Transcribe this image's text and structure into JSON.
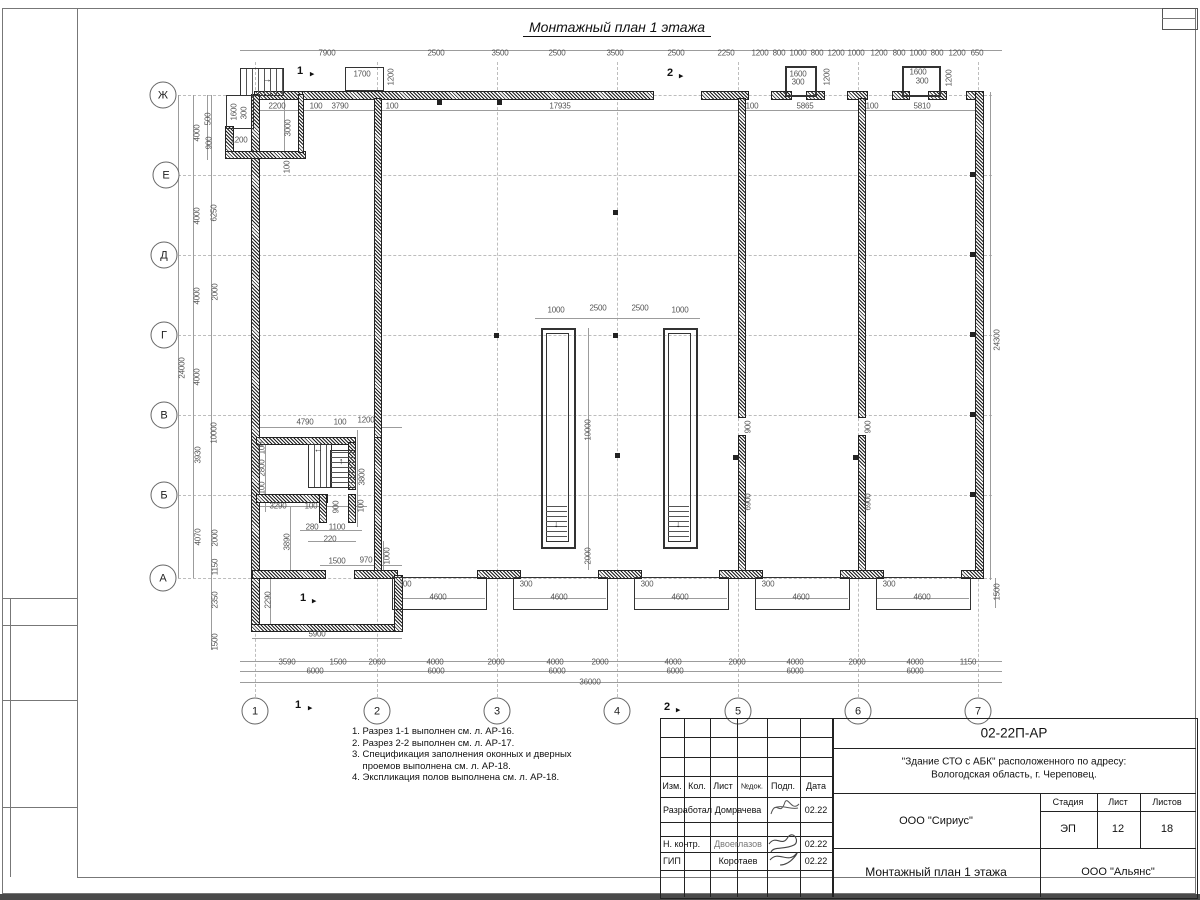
{
  "sheet": {
    "title": "Монтажный план 1 этажа"
  },
  "notes": {
    "lines": [
      "1. Разрез 1-1 выполнен см. л. АР-16.",
      "2. Разрез 2-2 выполнен см. л. АР-17.",
      "3. Спецификация заполнения оконных и дверных",
      "    проемов выполнена см. л. АР-18.",
      "4. Экспликация полов выполнена см. л. АР-18."
    ]
  },
  "stamp": {
    "doc_code": "02-22П-АР",
    "object_line1": "\"Здание СТО с АБК\" расположенного по адресу:",
    "object_line2": "Вологодская область, г. Череповец.",
    "org": "ООО \"Сириус\"",
    "drawing_name": "Монтажный план 1 этажа",
    "org2": "ООО \"Альянс\"",
    "header": {
      "izm": "Изм.",
      "kol": "Кол.",
      "list": "Лист",
      "ndoc": "№док.",
      "podp": "Подп.",
      "data": "Дата"
    },
    "stage_label": "Стадия",
    "sheet_label": "Лист",
    "sheets_label": "Листов",
    "stage": "ЭП",
    "sheet_no": "12",
    "sheets_total": "18",
    "rows": [
      {
        "role": "Разработал",
        "name": "Домрачева",
        "date": "02.22"
      },
      {
        "role": "Н. контр.",
        "name": "Двоеглазов",
        "date": "02.22"
      },
      {
        "role": "ГИП",
        "name": "Коротаев",
        "date": "02.22"
      }
    ]
  },
  "plan": {
    "axes_v": [
      255,
      377,
      497,
      617,
      738,
      858,
      978
    ],
    "axes_h": [
      95,
      175,
      255,
      335,
      415,
      495,
      578
    ],
    "bubbles": [
      {
        "t": "Ж",
        "x": 163,
        "y": 95
      },
      {
        "t": "Е",
        "x": 166,
        "y": 175
      },
      {
        "t": "Д",
        "x": 164,
        "y": 255
      },
      {
        "t": "Г",
        "x": 164,
        "y": 335
      },
      {
        "t": "В",
        "x": 164,
        "y": 415
      },
      {
        "t": "Б",
        "x": 164,
        "y": 495
      },
      {
        "t": "А",
        "x": 163,
        "y": 578
      },
      {
        "t": "1",
        "x": 255,
        "y": 711
      },
      {
        "t": "2",
        "x": 377,
        "y": 711
      },
      {
        "t": "3",
        "x": 497,
        "y": 711
      },
      {
        "t": "4",
        "x": 617,
        "y": 711
      },
      {
        "t": "5",
        "x": 738,
        "y": 711
      },
      {
        "t": "6",
        "x": 858,
        "y": 711
      },
      {
        "t": "7",
        "x": 978,
        "y": 711
      }
    ],
    "walls": [
      [
        255,
        92,
        48,
        7
      ],
      [
        303,
        92,
        350,
        7
      ],
      [
        702,
        92,
        46,
        7
      ],
      [
        772,
        92,
        19,
        7
      ],
      [
        807,
        92,
        17,
        7
      ],
      [
        848,
        92,
        19,
        7
      ],
      [
        893,
        92,
        16,
        7
      ],
      [
        929,
        92,
        17,
        7
      ],
      [
        967,
        92,
        16,
        7
      ],
      [
        976,
        92,
        7,
        486
      ],
      [
        252,
        95,
        7,
        536
      ],
      [
        226,
        127,
        7,
        26
      ],
      [
        226,
        152,
        79,
        6
      ],
      [
        299,
        95,
        4,
        57
      ],
      [
        375,
        99,
        6,
        339
      ],
      [
        375,
        438,
        6,
        133
      ],
      [
        739,
        99,
        6,
        318
      ],
      [
        739,
        436,
        6,
        135
      ],
      [
        859,
        99,
        6,
        318
      ],
      [
        859,
        436,
        6,
        135
      ],
      [
        257,
        438,
        98,
        6
      ],
      [
        349,
        443,
        6,
        46
      ],
      [
        257,
        495,
        70,
        7
      ],
      [
        320,
        495,
        6,
        27
      ],
      [
        349,
        495,
        6,
        27
      ],
      [
        478,
        571,
        42,
        7
      ],
      [
        599,
        571,
        42,
        7
      ],
      [
        720,
        571,
        42,
        7
      ],
      [
        841,
        571,
        42,
        7
      ],
      [
        962,
        571,
        21,
        7
      ],
      [
        253,
        571,
        72,
        7
      ],
      [
        355,
        571,
        42,
        7
      ],
      [
        252,
        625,
        150,
        6
      ],
      [
        395,
        576,
        7,
        55
      ]
    ],
    "outlines": [
      {
        "x": 226,
        "y": 95,
        "w": 26,
        "h": 32,
        "b": 1
      },
      {
        "x": 345,
        "y": 67,
        "w": 37,
        "h": 22,
        "b": 1
      },
      {
        "x": 785,
        "y": 66,
        "w": 28,
        "h": 27,
        "b": 2
      },
      {
        "x": 902,
        "y": 66,
        "w": 35,
        "h": 27,
        "b": 2
      },
      {
        "x": 541,
        "y": 328,
        "w": 31,
        "h": 217,
        "b": 2
      },
      {
        "x": 546,
        "y": 333,
        "w": 21,
        "h": 207,
        "b": 1
      },
      {
        "x": 663,
        "y": 328,
        "w": 31,
        "h": 217,
        "b": 2
      },
      {
        "x": 668,
        "y": 333,
        "w": 21,
        "h": 207,
        "b": 1
      },
      {
        "x": 392,
        "y": 577,
        "w": 93,
        "h": 31,
        "b": 1
      },
      {
        "x": 513,
        "y": 577,
        "w": 93,
        "h": 31,
        "b": 1
      },
      {
        "x": 634,
        "y": 577,
        "w": 93,
        "h": 31,
        "b": 1
      },
      {
        "x": 755,
        "y": 577,
        "w": 93,
        "h": 31,
        "b": 1
      },
      {
        "x": 876,
        "y": 577,
        "w": 93,
        "h": 31,
        "b": 1
      },
      {
        "x": 240,
        "y": 68,
        "w": 42,
        "h": 26,
        "b": 1,
        "s": "stripes-v"
      },
      {
        "x": 308,
        "y": 444,
        "w": 22,
        "h": 42,
        "b": 1,
        "s": "stripes-v"
      },
      {
        "x": 330,
        "y": 450,
        "w": 24,
        "h": 36,
        "b": 1,
        "s": "stripes-h"
      },
      {
        "x": 546,
        "y": 505,
        "w": 21,
        "h": 36,
        "b": 0,
        "s": "stripes-h"
      },
      {
        "x": 668,
        "y": 505,
        "w": 21,
        "h": 36,
        "b": 0,
        "s": "stripes-h"
      }
    ],
    "squares": [
      [
        437,
        100
      ],
      [
        497,
        100
      ],
      [
        613,
        210
      ],
      [
        613,
        333
      ],
      [
        615,
        453
      ],
      [
        494,
        333
      ],
      [
        970,
        172
      ],
      [
        970,
        252
      ],
      [
        970,
        332
      ],
      [
        970,
        412
      ],
      [
        970,
        492
      ],
      [
        733,
        455
      ],
      [
        853,
        455
      ]
    ],
    "dimlines": [
      [
        240,
        50,
        762,
        1
      ],
      [
        255,
        110,
        727,
        1
      ],
      [
        535,
        318,
        165,
        1
      ],
      [
        255,
        427,
        147,
        1
      ],
      [
        255,
        506,
        112,
        1
      ],
      [
        300,
        530,
        62,
        1
      ],
      [
        308,
        541,
        48,
        1
      ],
      [
        320,
        565,
        82,
        1
      ],
      [
        392,
        598,
        93,
        1
      ],
      [
        513,
        598,
        93,
        1
      ],
      [
        634,
        598,
        93,
        1
      ],
      [
        755,
        598,
        93,
        1
      ],
      [
        876,
        598,
        93,
        1
      ],
      [
        252,
        638,
        150,
        1
      ],
      [
        240,
        661,
        762,
        1
      ],
      [
        240,
        671,
        762,
        1
      ],
      [
        240,
        682,
        762,
        1
      ],
      [
        178,
        95,
        1,
        483
      ],
      [
        193,
        95,
        1,
        483
      ],
      [
        211,
        95,
        1,
        555
      ],
      [
        990,
        92,
        1,
        488
      ],
      [
        995,
        578,
        1,
        30
      ],
      [
        588,
        328,
        1,
        242
      ],
      [
        265,
        438,
        1,
        74
      ],
      [
        290,
        506,
        1,
        72
      ],
      [
        357,
        430,
        1,
        97
      ],
      [
        383,
        541,
        1,
        31
      ],
      [
        270,
        578,
        1,
        50
      ],
      [
        284,
        99,
        1,
        53
      ],
      [
        207,
        95,
        1,
        65
      ]
    ],
    "labels": [
      {
        "t": "7900",
        "x": 327,
        "y": 53
      },
      {
        "t": "2500",
        "x": 436,
        "y": 53
      },
      {
        "t": "3500",
        "x": 500,
        "y": 53
      },
      {
        "t": "2500",
        "x": 557,
        "y": 53
      },
      {
        "t": "3500",
        "x": 615,
        "y": 53
      },
      {
        "t": "2500",
        "x": 676,
        "y": 53
      },
      {
        "t": "2250",
        "x": 726,
        "y": 53
      },
      {
        "t": "1200",
        "x": 760,
        "y": 53
      },
      {
        "t": "800",
        "x": 779,
        "y": 53
      },
      {
        "t": "1000",
        "x": 798,
        "y": 53
      },
      {
        "t": "800",
        "x": 817,
        "y": 53
      },
      {
        "t": "1200",
        "x": 836,
        "y": 53
      },
      {
        "t": "1000",
        "x": 856,
        "y": 53
      },
      {
        "t": "1200",
        "x": 879,
        "y": 53
      },
      {
        "t": "800",
        "x": 899,
        "y": 53
      },
      {
        "t": "1000",
        "x": 918,
        "y": 53
      },
      {
        "t": "800",
        "x": 937,
        "y": 53
      },
      {
        "t": "1200",
        "x": 957,
        "y": 53
      },
      {
        "t": "650",
        "x": 977,
        "y": 53
      },
      {
        "t": "1700",
        "x": 362,
        "y": 74
      },
      {
        "t": "1200",
        "x": 391,
        "y": 77,
        "r": 1
      },
      {
        "t": "1600",
        "x": 798,
        "y": 74
      },
      {
        "t": "300",
        "x": 798,
        "y": 82
      },
      {
        "t": "1200",
        "x": 827,
        "y": 77,
        "r": 1
      },
      {
        "t": "1600",
        "x": 918,
        "y": 72
      },
      {
        "t": "300",
        "x": 922,
        "y": 81
      },
      {
        "t": "1200",
        "x": 949,
        "y": 78,
        "r": 1
      },
      {
        "t": "2200",
        "x": 277,
        "y": 106
      },
      {
        "t": "100",
        "x": 316,
        "y": 106
      },
      {
        "t": "3790",
        "x": 340,
        "y": 106
      },
      {
        "t": "100",
        "x": 392,
        "y": 106
      },
      {
        "t": "17935",
        "x": 560,
        "y": 106
      },
      {
        "t": "100",
        "x": 752,
        "y": 106
      },
      {
        "t": "5865",
        "x": 805,
        "y": 106
      },
      {
        "t": "100",
        "x": 872,
        "y": 106
      },
      {
        "t": "5810",
        "x": 922,
        "y": 106
      },
      {
        "t": "1600",
        "x": 234,
        "y": 112,
        "r": 1
      },
      {
        "t": "300",
        "x": 244,
        "y": 113,
        "r": 1
      },
      {
        "t": "1200",
        "x": 239,
        "y": 140
      },
      {
        "t": "3000",
        "x": 288,
        "y": 128,
        "r": 1
      },
      {
        "t": "100",
        "x": 287,
        "y": 167,
        "r": 1
      },
      {
        "t": "24000",
        "x": 182,
        "y": 368,
        "r": 1
      },
      {
        "t": "4000",
        "x": 197,
        "y": 133,
        "r": 1
      },
      {
        "t": "4000",
        "x": 197,
        "y": 216,
        "r": 1
      },
      {
        "t": "4000",
        "x": 197,
        "y": 296,
        "r": 1
      },
      {
        "t": "4000",
        "x": 197,
        "y": 377,
        "r": 1
      },
      {
        "t": "3930",
        "x": 198,
        "y": 455,
        "r": 1
      },
      {
        "t": "4070",
        "x": 198,
        "y": 537,
        "r": 1
      },
      {
        "t": "500",
        "x": 208,
        "y": 119,
        "r": 1
      },
      {
        "t": "900",
        "x": 209,
        "y": 143,
        "r": 1
      },
      {
        "t": "6250",
        "x": 214,
        "y": 213,
        "r": 1
      },
      {
        "t": "2000",
        "x": 215,
        "y": 292,
        "r": 1
      },
      {
        "t": "10000",
        "x": 214,
        "y": 433,
        "r": 1
      },
      {
        "t": "2000",
        "x": 215,
        "y": 538,
        "r": 1
      },
      {
        "t": "1150",
        "x": 215,
        "y": 567,
        "r": 1
      },
      {
        "t": "2350",
        "x": 215,
        "y": 600,
        "r": 1
      },
      {
        "t": "1500",
        "x": 215,
        "y": 642,
        "r": 1
      },
      {
        "t": "24300",
        "x": 997,
        "y": 340,
        "r": 1
      },
      {
        "t": "1500",
        "x": 997,
        "y": 592,
        "r": 1
      },
      {
        "t": "1000",
        "x": 556,
        "y": 310
      },
      {
        "t": "2500",
        "x": 598,
        "y": 308
      },
      {
        "t": "2500",
        "x": 640,
        "y": 308
      },
      {
        "t": "1000",
        "x": 680,
        "y": 310
      },
      {
        "t": "10000",
        "x": 588,
        "y": 430,
        "r": 1
      },
      {
        "t": "2000",
        "x": 588,
        "y": 556,
        "r": 1
      },
      {
        "t": "900",
        "x": 748,
        "y": 427,
        "r": 1
      },
      {
        "t": "6900",
        "x": 748,
        "y": 502,
        "r": 1
      },
      {
        "t": "900",
        "x": 868,
        "y": 427,
        "r": 1
      },
      {
        "t": "6900",
        "x": 868,
        "y": 502,
        "r": 1
      },
      {
        "t": "4790",
        "x": 305,
        "y": 422
      },
      {
        "t": "100",
        "x": 340,
        "y": 422
      },
      {
        "t": "1200",
        "x": 366,
        "y": 420
      },
      {
        "t": "100",
        "x": 262,
        "y": 448,
        "r": 1
      },
      {
        "t": "2800",
        "x": 262,
        "y": 468,
        "r": 1
      },
      {
        "t": "100",
        "x": 262,
        "y": 488,
        "r": 1
      },
      {
        "t": "3800",
        "x": 362,
        "y": 477,
        "r": 1
      },
      {
        "t": "3290",
        "x": 278,
        "y": 506
      },
      {
        "t": "100",
        "x": 311,
        "y": 506
      },
      {
        "t": "900",
        "x": 336,
        "y": 507,
        "r": 1
      },
      {
        "t": "100",
        "x": 361,
        "y": 506,
        "r": 1
      },
      {
        "t": "280",
        "x": 312,
        "y": 527
      },
      {
        "t": "1100",
        "x": 337,
        "y": 527
      },
      {
        "t": "220",
        "x": 330,
        "y": 539
      },
      {
        "t": "3890",
        "x": 287,
        "y": 542,
        "r": 1
      },
      {
        "t": "1000",
        "x": 387,
        "y": 556,
        "r": 1
      },
      {
        "t": "1500",
        "x": 337,
        "y": 561
      },
      {
        "t": "970",
        "x": 366,
        "y": 560
      },
      {
        "t": "2290",
        "x": 268,
        "y": 600,
        "r": 1
      },
      {
        "t": "5900",
        "x": 317,
        "y": 634
      },
      {
        "t": "300",
        "x": 405,
        "y": 584
      },
      {
        "t": "4600",
        "x": 438,
        "y": 597
      },
      {
        "t": "300",
        "x": 526,
        "y": 584
      },
      {
        "t": "4600",
        "x": 559,
        "y": 597
      },
      {
        "t": "300",
        "x": 647,
        "y": 584
      },
      {
        "t": "4600",
        "x": 680,
        "y": 597
      },
      {
        "t": "300",
        "x": 768,
        "y": 584
      },
      {
        "t": "4600",
        "x": 801,
        "y": 597
      },
      {
        "t": "300",
        "x": 889,
        "y": 584
      },
      {
        "t": "4600",
        "x": 922,
        "y": 597
      },
      {
        "t": "3590",
        "x": 287,
        "y": 662
      },
      {
        "t": "1500",
        "x": 338,
        "y": 662
      },
      {
        "t": "2060",
        "x": 377,
        "y": 662
      },
      {
        "t": "4000",
        "x": 435,
        "y": 662
      },
      {
        "t": "2000",
        "x": 496,
        "y": 662
      },
      {
        "t": "4000",
        "x": 555,
        "y": 662
      },
      {
        "t": "2000",
        "x": 600,
        "y": 662
      },
      {
        "t": "4000",
        "x": 673,
        "y": 662
      },
      {
        "t": "2000",
        "x": 737,
        "y": 662
      },
      {
        "t": "4000",
        "x": 795,
        "y": 662
      },
      {
        "t": "2000",
        "x": 857,
        "y": 662
      },
      {
        "t": "4000",
        "x": 915,
        "y": 662
      },
      {
        "t": "1150",
        "x": 968,
        "y": 662
      },
      {
        "t": "6000",
        "x": 315,
        "y": 671
      },
      {
        "t": "6000",
        "x": 436,
        "y": 671
      },
      {
        "t": "6000",
        "x": 557,
        "y": 671
      },
      {
        "t": "6000",
        "x": 675,
        "y": 671
      },
      {
        "t": "6000",
        "x": 795,
        "y": 671
      },
      {
        "t": "6000",
        "x": 915,
        "y": 671
      },
      {
        "t": "36000",
        "x": 590,
        "y": 682
      },
      {
        "t": "1",
        "x": 300,
        "y": 71,
        "c": "sec"
      },
      {
        "t": "2",
        "x": 670,
        "y": 73,
        "c": "sec"
      },
      {
        "t": "1",
        "x": 298,
        "y": 705,
        "c": "sec"
      },
      {
        "t": "2",
        "x": 667,
        "y": 707,
        "c": "sec"
      },
      {
        "t": "1",
        "x": 303,
        "y": 598,
        "c": "sec"
      },
      {
        "t": "▸",
        "x": 312,
        "y": 74,
        "c": "arr"
      },
      {
        "t": "▸",
        "x": 681,
        "y": 76,
        "c": "arr"
      },
      {
        "t": "▸",
        "x": 310,
        "y": 708,
        "c": "arr"
      },
      {
        "t": "▸",
        "x": 678,
        "y": 710,
        "c": "arr"
      },
      {
        "t": "▸",
        "x": 314,
        "y": 601,
        "c": "arr"
      },
      {
        "t": "→",
        "x": 267,
        "y": 79,
        "c": "arr"
      },
      {
        "t": "↓",
        "x": 556,
        "y": 524,
        "c": "arr"
      },
      {
        "t": "↓",
        "x": 678,
        "y": 524,
        "c": "arr"
      },
      {
        "t": "↑",
        "x": 341,
        "y": 461,
        "c": "arr"
      },
      {
        "t": "←",
        "x": 318,
        "y": 449,
        "c": "arr"
      }
    ]
  }
}
